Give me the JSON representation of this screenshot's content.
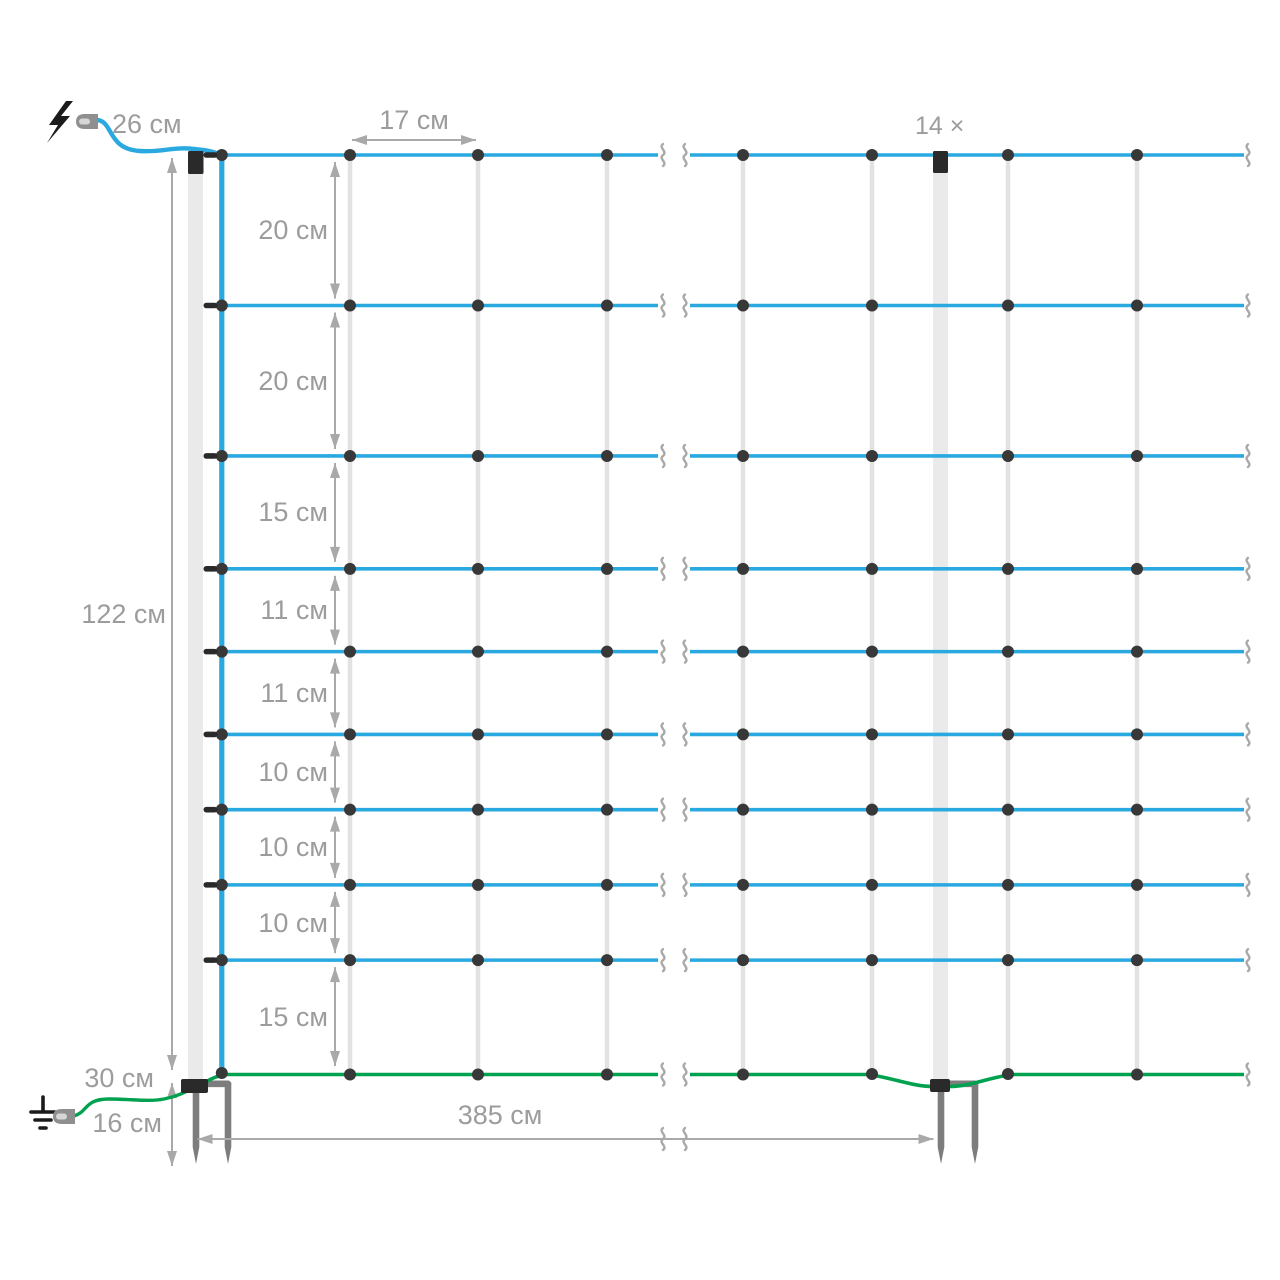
{
  "diagram": {
    "kind": "electric-fence-netting-dimensions",
    "unit": "см",
    "labels": {
      "top_cable": "26 см",
      "mesh_width": "17 см",
      "post_count": "14 ×",
      "net_height": "122 см",
      "bottom_cable": "30 см",
      "spike_length": "16 см",
      "post_spacing": "385 см"
    },
    "row_spacings": {
      "values_cm": [
        20,
        20,
        15,
        11,
        11,
        10,
        10,
        10,
        15
      ],
      "labels": [
        "20 см",
        "20 см",
        "15 см",
        "11 см",
        "11 см",
        "10 см",
        "10 см",
        "10 см",
        "15 см"
      ]
    },
    "net_height_cm": 122,
    "mesh_width_cm": 17,
    "post_spacing_cm": 385,
    "post_count": 14,
    "spike_length_cm": 16,
    "horizontal_wires": 10,
    "icons": [
      "lightning-icon",
      "ground-icon"
    ],
    "colors": {
      "live_wire": "#29a9e0",
      "ground_wire": "#00a14f",
      "dimension": "#a9a9a9",
      "label_text": "#9c9c9c",
      "string": "#e2e2e2",
      "post": "#eaeaea",
      "post_base": "#7d7d7d",
      "hardware": "#2a2a2a",
      "connector": "#8f8f8f"
    }
  }
}
